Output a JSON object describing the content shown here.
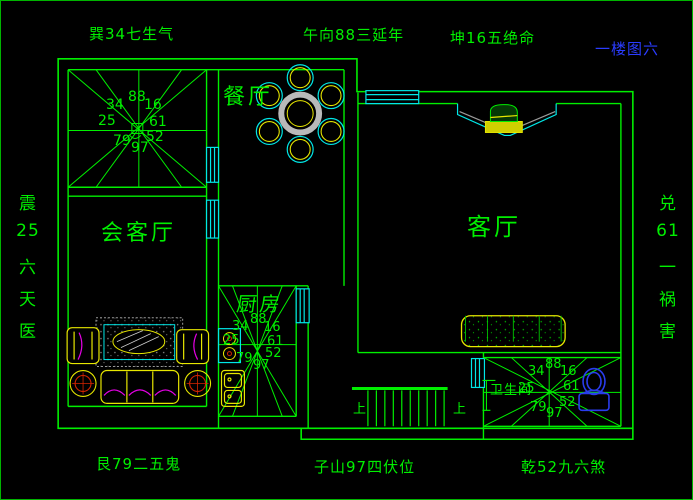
{
  "title": "一楼图六",
  "compass": {
    "top_left": "巽34七生气",
    "top_center": "午向88三延年",
    "top_right": "坤16五绝命",
    "bottom_left": "艮79二五鬼",
    "bottom_center": "子山97四伏位",
    "bottom_right": "乾52九六煞",
    "left_vertical": [
      "震",
      "25",
      "六",
      "天",
      "医"
    ],
    "right_vertical": [
      "兑",
      "61",
      "一",
      "祸",
      "害"
    ]
  },
  "rooms": {
    "dining": "餐厅",
    "reception": "会客厅",
    "living": "客厅",
    "kitchen": "厨房",
    "bathroom": "卫生间"
  },
  "stairs": {
    "up_left": "上",
    "up_right": "上"
  },
  "star_numbers": {
    "nw": "34",
    "n": "88",
    "ne": "16",
    "w": "25",
    "e": "61",
    "sw": "79",
    "s": "97",
    "se": "52"
  },
  "colors": {
    "wall": "#00ef00",
    "window": "#00e7e7",
    "furniture": "#e7e700",
    "accent": "#e700e7",
    "fixture_blue": "#2a3cee",
    "table_gray": "#b9b9b9",
    "title_blue": "#2a3cff",
    "background": "#000000"
  }
}
